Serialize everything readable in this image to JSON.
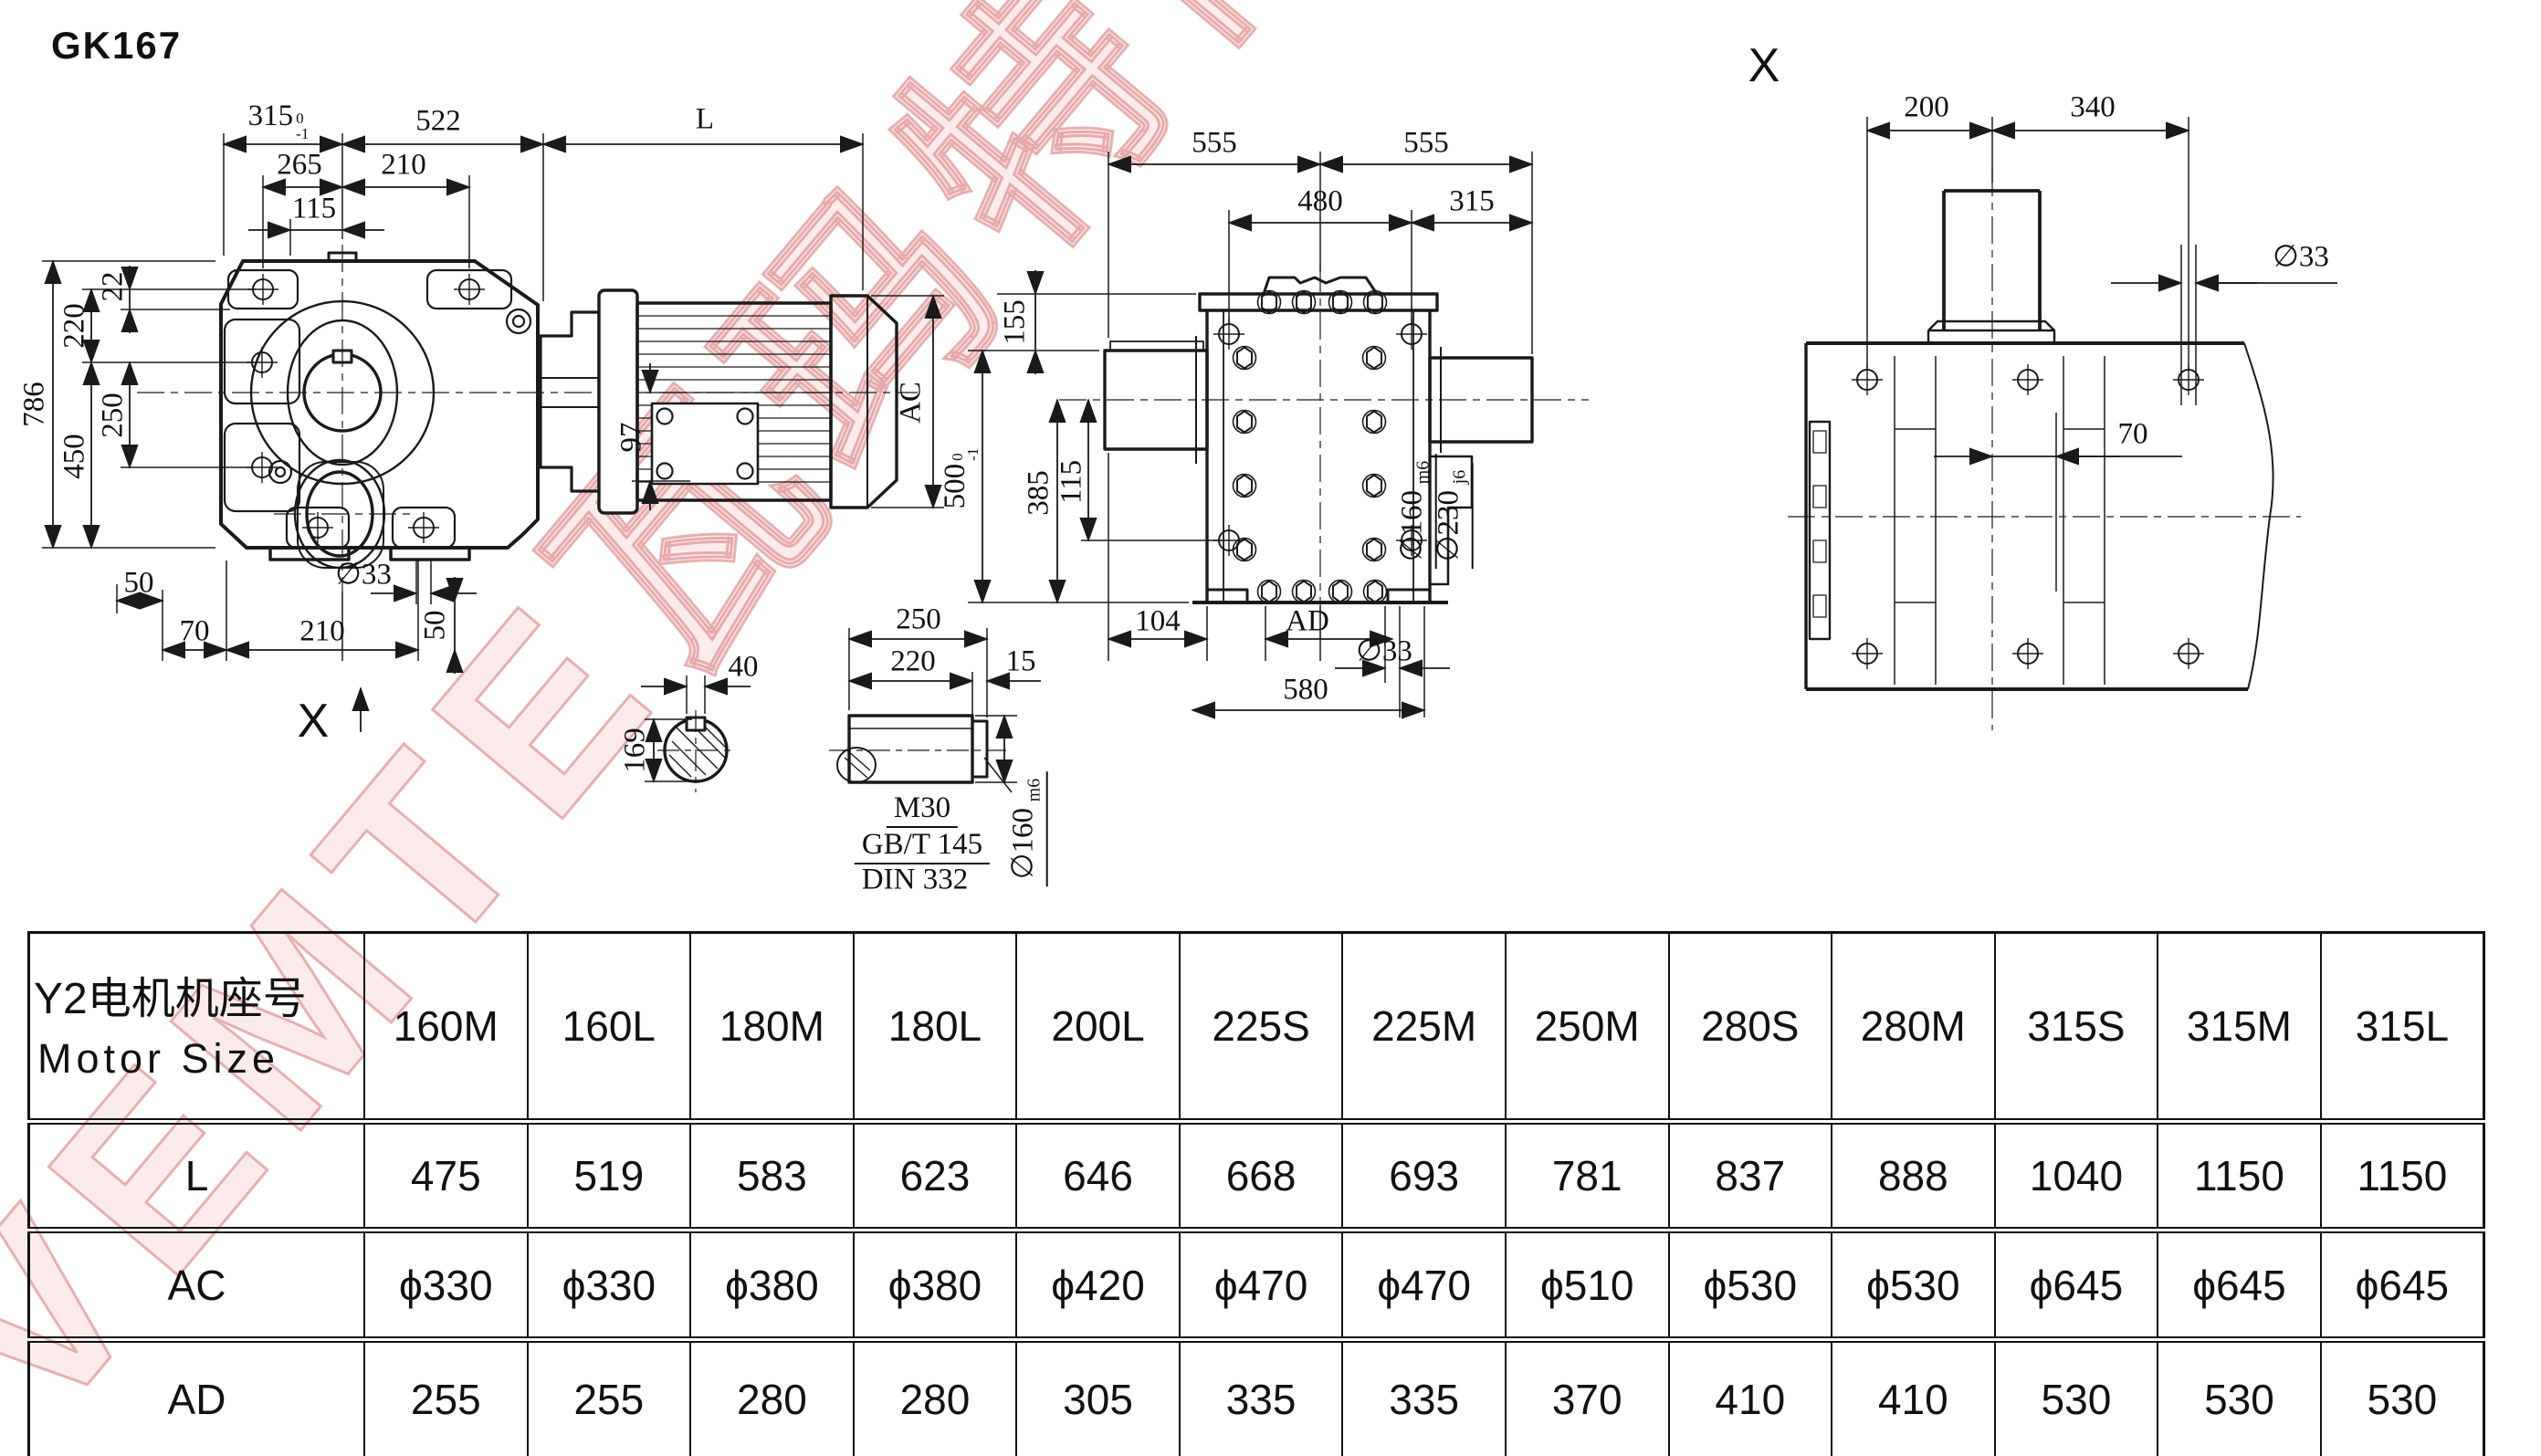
{
  "title": "GK167",
  "watermark": {
    "text": "VEMTE瓦玛特传动",
    "color": "#e5a0a0"
  },
  "views": {
    "front": {
      "dims": {
        "d315": "315",
        "d315_tu": "0",
        "d315_tl": "-1",
        "d522": "522",
        "dL": "L",
        "d265": "265",
        "d210": "210",
        "d115": "115",
        "d22": "22",
        "d220": "220",
        "d250": "250",
        "d450": "450",
        "d786": "786",
        "d97": "97",
        "dAC": "AC",
        "d50a": "50",
        "d33": "∅33",
        "d70": "70",
        "d210b": "210",
        "d50b": "50",
        "view_arrow": "X"
      }
    },
    "side": {
      "dims": {
        "d555a": "555",
        "d555b": "555",
        "d480": "480",
        "d315": "315",
        "d155": "155",
        "d385": "385",
        "d500": "500",
        "d500_tu": "0",
        "d500_tl": "-1",
        "d115": "115",
        "d104": "104",
        "dAD": "AD",
        "d33": "∅33",
        "d580": "580",
        "d160": "∅160",
        "d160_fit": "m6",
        "d230": "∅230",
        "d230_fit": "j6"
      }
    },
    "xview": {
      "label": "X",
      "dims": {
        "d200": "200",
        "d340": "340",
        "d33": "∅33",
        "d70": "70"
      }
    },
    "shaft_detail": {
      "dims": {
        "d40": "40",
        "d169": "169",
        "d250": "250",
        "d220": "220",
        "d15": "15",
        "thread": "M30",
        "std1": "GB/T 145",
        "std2": "DIN 332",
        "d160": "∅160",
        "d160_fit": "m6"
      }
    }
  },
  "table": {
    "header_cn": "Y2电机机座号",
    "header_en": "Motor Size",
    "columns": [
      "160M",
      "160L",
      "180M",
      "180L",
      "200L",
      "225S",
      "225M",
      "250M",
      "280S",
      "280M",
      "315S",
      "315M",
      "315L"
    ],
    "rows": [
      {
        "label": "L",
        "values": [
          "475",
          "519",
          "583",
          "623",
          "646",
          "668",
          "693",
          "781",
          "837",
          "888",
          "1040",
          "1150",
          "1150"
        ]
      },
      {
        "label": "AC",
        "values": [
          "ϕ330",
          "ϕ330",
          "ϕ380",
          "ϕ380",
          "ϕ420",
          "ϕ470",
          "ϕ470",
          "ϕ510",
          "ϕ530",
          "ϕ530",
          "ϕ645",
          "ϕ645",
          "ϕ645"
        ]
      },
      {
        "label": "AD",
        "values": [
          "255",
          "255",
          "280",
          "280",
          "305",
          "335",
          "335",
          "370",
          "410",
          "410",
          "530",
          "530",
          "530"
        ]
      }
    ]
  }
}
